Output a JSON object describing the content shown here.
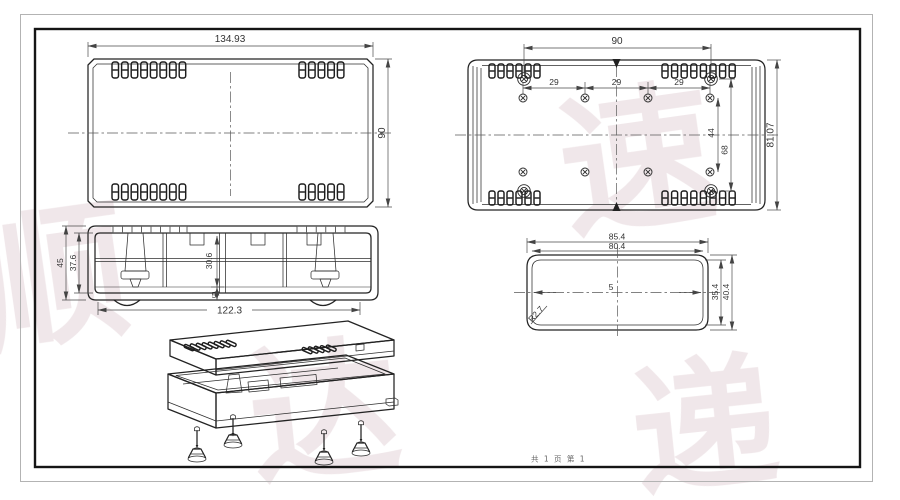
{
  "page": {
    "footer_text": "共 1 页  第 1",
    "background": "#ffffff",
    "line_color": "#232323",
    "dim_color": "#4a4a4a",
    "outer_border_color": "#b3b3b3",
    "inner_border_color": "#151515",
    "watermark_color": "#efe5e8",
    "watermark_chars": [
      "顺",
      "达",
      "速",
      "递"
    ]
  },
  "views": {
    "top_view": {
      "dim_width": "134.93",
      "dim_height": "90"
    },
    "inside_view": {
      "dim_boss_span": "90",
      "dim_pitch_1": "29",
      "dim_pitch_2": "29",
      "dim_pitch_3": "29",
      "dim_row_span": "44",
      "dim_boss_rows": "68",
      "dim_height": "81.07"
    },
    "section_view": {
      "dim_outer_height": "45",
      "dim_inner_height": "37.6",
      "dim_rib_depth": "30.6",
      "dim_ledge": "5",
      "dim_width": "122.3"
    },
    "end_view": {
      "dim_outer_width": "85.4",
      "dim_inner_width": "80.4",
      "dim_inner_height": "35.4",
      "dim_outer_height": "40.4",
      "dim_corner_radius": "R2.7",
      "dim_center": "5"
    }
  }
}
